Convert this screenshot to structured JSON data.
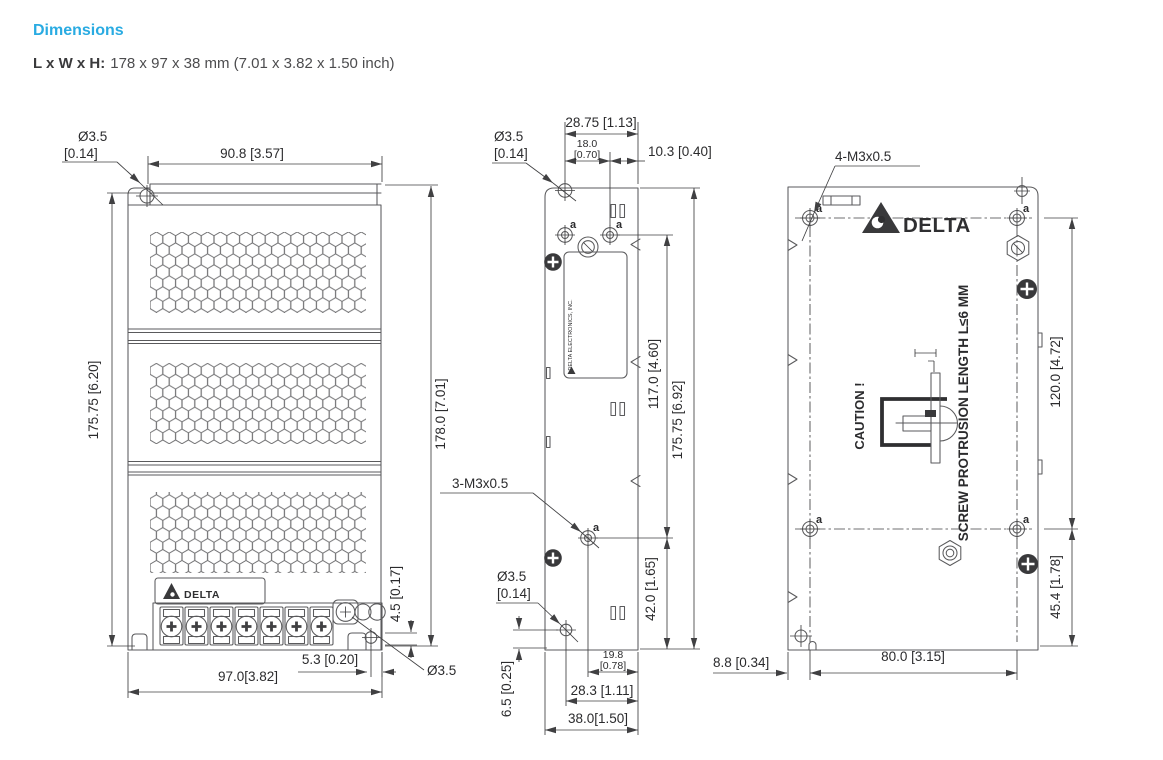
{
  "header": {
    "title": "Dimensions",
    "size_label": "L x W x H:",
    "size_value": "178 x 97 x 38 mm (7.01 x 3.82 x 1.50 inch)"
  },
  "colors": {
    "accent": "#29abe2",
    "line": "#5a5a5c",
    "dim": "#404042",
    "text": "#2b2b2d"
  },
  "front_view": {
    "hole_callout": {
      "diameter": "Ø3.5",
      "inches": "[0.14]"
    },
    "top_width": "90.8 [3.57]",
    "height_left": "175.75 [6.20]",
    "height_right": "178.0 [7.01]",
    "terminal_height": "4.5 [0.17]",
    "hole_offset": "5.3 [0.20]",
    "bottom_width": "97.0[3.82]",
    "bottom_hole": "Ø3.5",
    "logo": "DELTA"
  },
  "side_view": {
    "hole_callout_top": {
      "diameter": "Ø3.5",
      "inches": "[0.14]"
    },
    "top_width_full": "28.75 [1.13]",
    "top_width_inner": {
      "mm": "18.0",
      "inches": "[0.70]"
    },
    "top_width_right": "10.3 [0.40]",
    "hole_label": "a",
    "height_holes": "117.0 [4.60]",
    "height_full": "175.75 [6.92]",
    "thread_callout": "3-M3x0.5",
    "hole_callout_bottom": {
      "diameter": "Ø3.5",
      "inches": "[0.14]"
    },
    "height_lower": "42.0 [1.65]",
    "bottom_hole_offset": "6.5 [0.25]",
    "bottom_width_inner": {
      "mm": "19.8",
      "inches": "[0.78]"
    },
    "bottom_width_mid": "28.3 [1.11]",
    "bottom_width_full": "38.0[1.50]",
    "sticker": "DELTA ELECTRONICS, INC."
  },
  "back_view": {
    "thread_callout": "4-M3x0.5",
    "logo": "DELTA",
    "hole_label": "a",
    "caution": "CAUTION !",
    "protrusion_note": "SCREW PROTRUSION LENGTH L≤6 MM",
    "height_holes": "120.0 [4.72]",
    "height_lower": "45.4 [1.78]",
    "bottom_offset": "8.8 [0.34]",
    "bottom_width": "80.0 [3.15]"
  }
}
